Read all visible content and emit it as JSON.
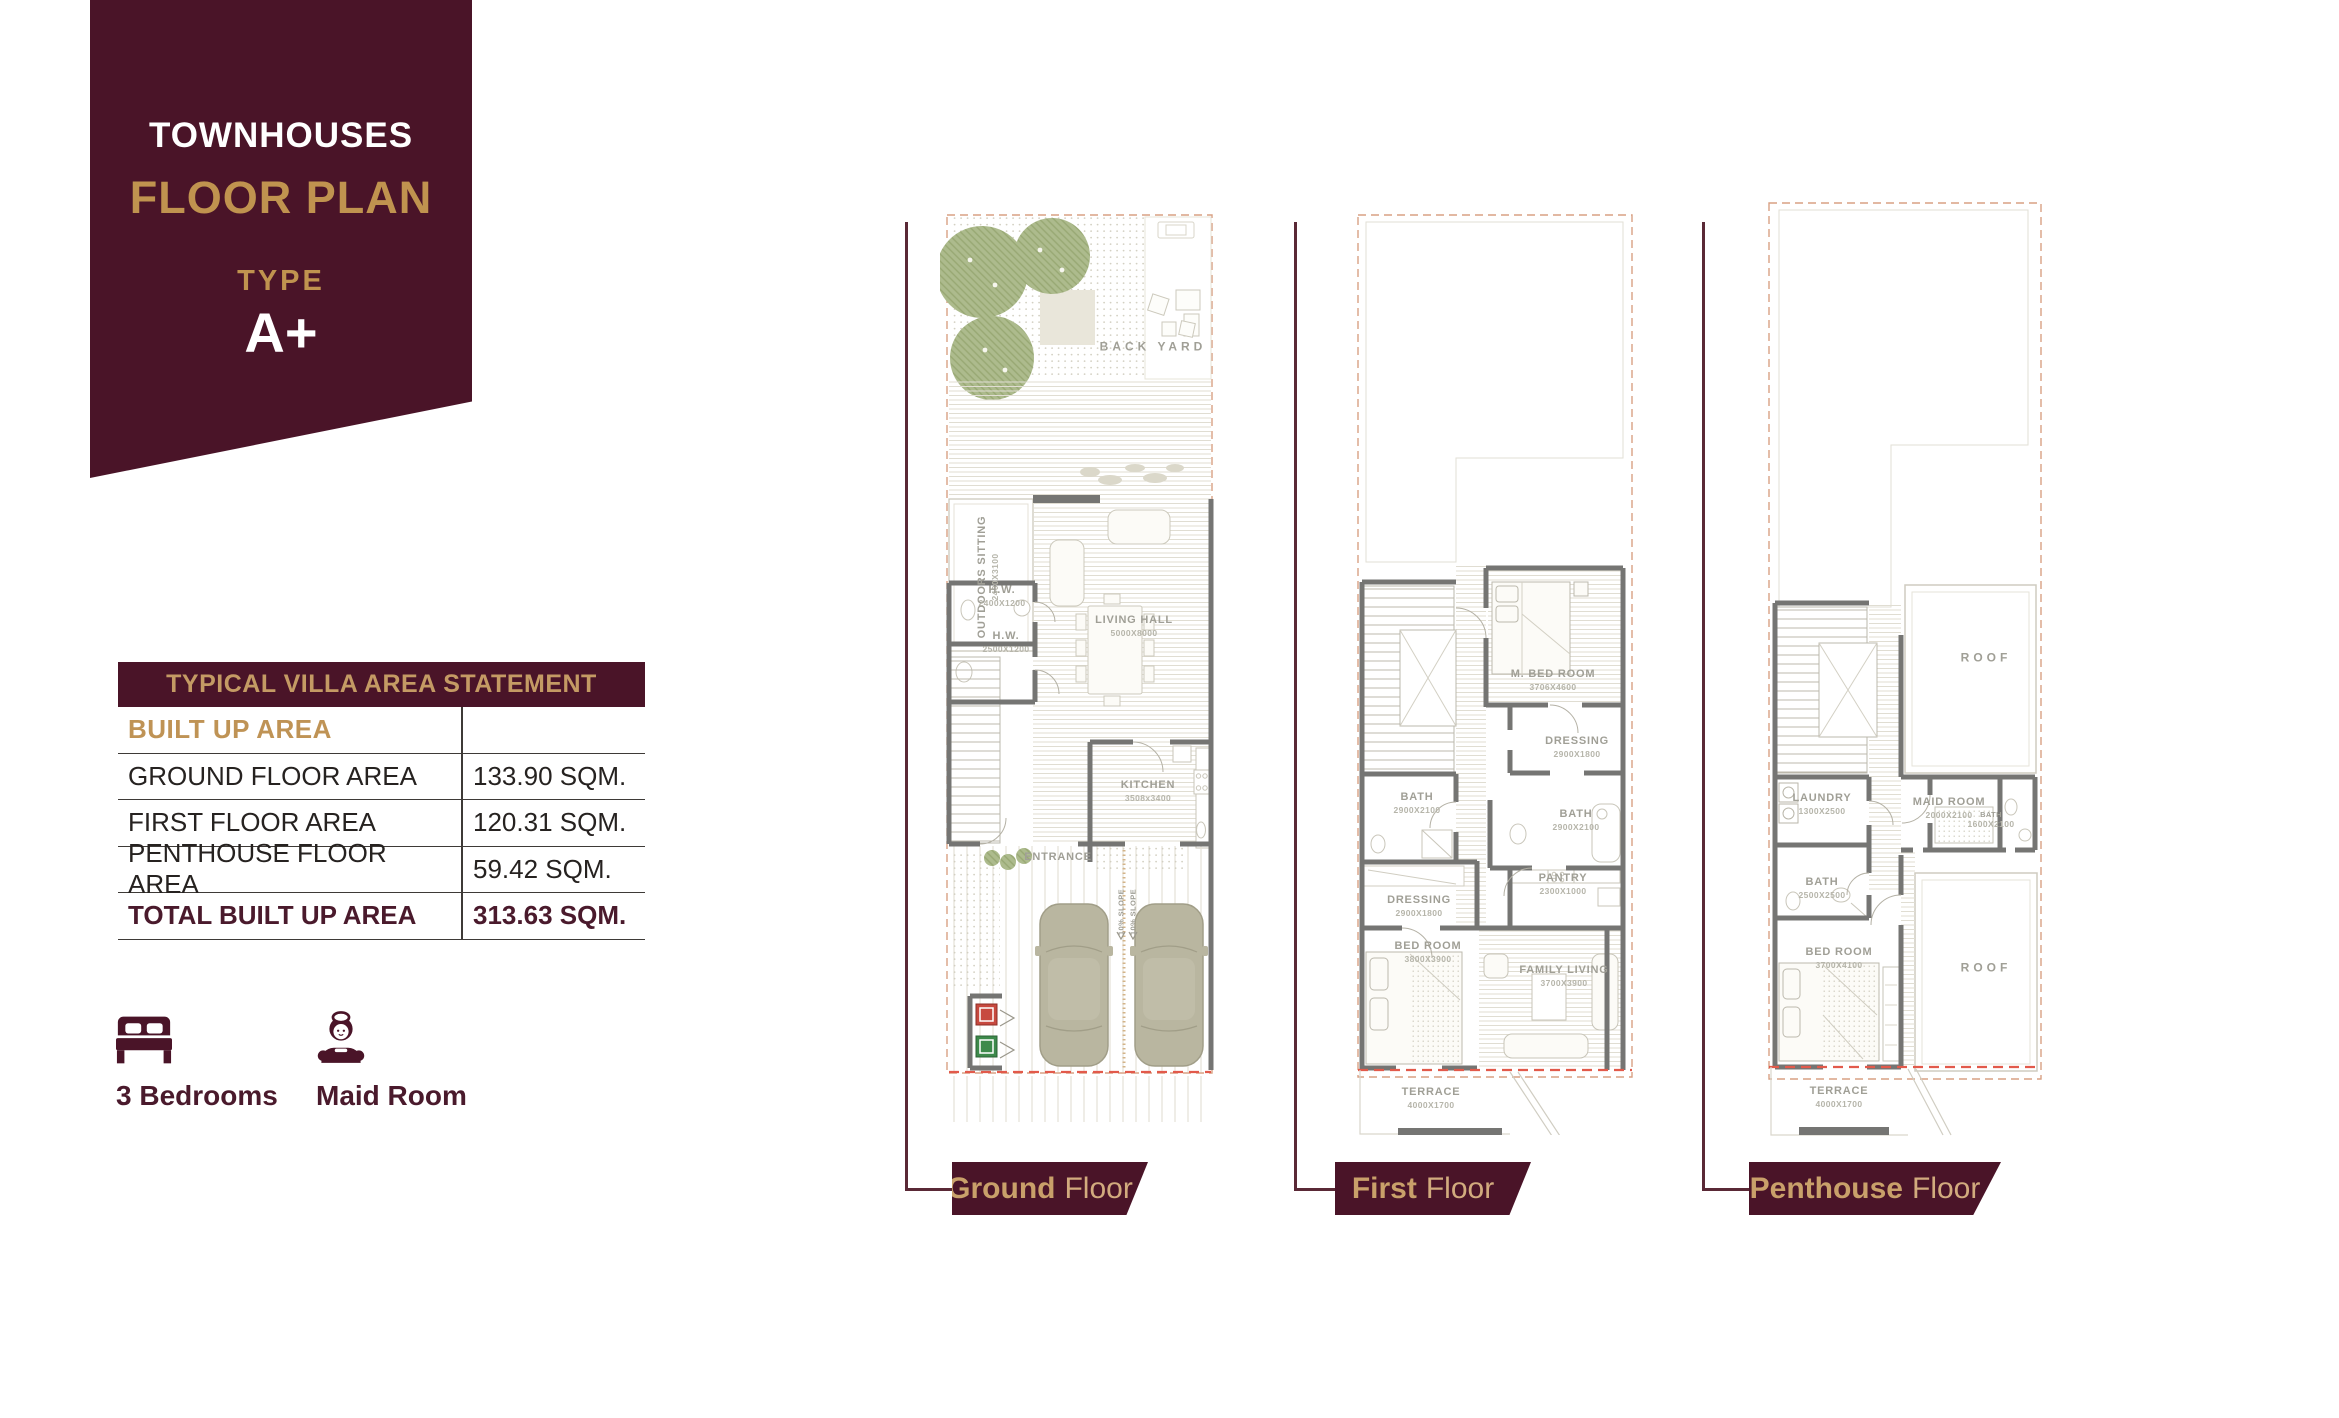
{
  "ribbon": {
    "line1": "TOWNHOUSES",
    "line2": "FLOOR PLAN",
    "type_label": "TYPE",
    "type_value": "A+"
  },
  "area_table": {
    "title": "TYPICAL VILLA AREA STATEMENT",
    "section_header": "BUILT UP AREA",
    "rows": [
      {
        "label": "GROUND FLOOR AREA",
        "value": "133.90 SQM."
      },
      {
        "label": "FIRST FLOOR AREA",
        "value": "120.31 SQM."
      },
      {
        "label": "PENTHOUSE FLOOR AREA",
        "value": "59.42 SQM."
      }
    ],
    "total": {
      "label": "TOTAL BUILT UP AREA",
      "value": "313.63 SQM."
    }
  },
  "features": [
    {
      "icon": "bed-icon",
      "label": "3 Bedrooms"
    },
    {
      "icon": "maid-icon",
      "label": "Maid Room"
    }
  ],
  "colors": {
    "maroon": "#4a1428",
    "gold": "#c0934f",
    "banner_gold": "#c9a06a",
    "wall_gray": "#757573",
    "boundary_dash": "#d9a184",
    "red_dash": "#e25a4b",
    "tree_green": "#adbb8d",
    "car_khaki": "#b9b6a0"
  },
  "plans": [
    {
      "name": "ground",
      "banner": {
        "bold": "Ground",
        "regular": "Floor"
      },
      "labels": [
        {
          "text": "BACK YARD"
        },
        {
          "text": "OUTDOORS SITTING",
          "dims": "2400X3100"
        },
        {
          "text": "H.W.",
          "dims": "2400X1200"
        },
        {
          "text": "H.W.",
          "dims": "2500X1200"
        },
        {
          "text": "LIVING HALL",
          "dims": "5000X8000"
        },
        {
          "text": "KITCHEN",
          "dims": "3508x3400"
        },
        {
          "text": "ENTRANCE"
        },
        {
          "text": "10% SLOPE"
        },
        {
          "text": "10% SLOPE"
        }
      ]
    },
    {
      "name": "first",
      "banner": {
        "bold": "First",
        "regular": "Floor"
      },
      "labels": [
        {
          "text": "M. BED ROOM",
          "dims": "3706X4600"
        },
        {
          "text": "DRESSING",
          "dims": "2900X1800"
        },
        {
          "text": "BATH",
          "dims": "2900X2100"
        },
        {
          "text": "BATH",
          "dims": "2900X2100"
        },
        {
          "text": "PANTRY",
          "dims": "2300X1000"
        },
        {
          "text": "DRESSING",
          "dims": "2900X1800"
        },
        {
          "text": "BED ROOM",
          "dims": "3800X3900"
        },
        {
          "text": "FAMILY LIVING",
          "dims": "3700X3900"
        },
        {
          "text": "TERRACE",
          "dims": "4000X1700"
        }
      ]
    },
    {
      "name": "penthouse",
      "banner": {
        "bold": "Penthouse",
        "regular": "Floor"
      },
      "labels": [
        {
          "text": "ROOF"
        },
        {
          "text": "LAUNDRY",
          "dims": "1300X2500"
        },
        {
          "text": "MAID ROOM",
          "dims": "2000X2100"
        },
        {
          "text": "BATH",
          "dims": "1600X2100"
        },
        {
          "text": "BATH",
          "dims": "2500X2500"
        },
        {
          "text": "BED ROOM",
          "dims": "3700X4100"
        },
        {
          "text": "ROOF"
        },
        {
          "text": "TERRACE",
          "dims": "4000X1700"
        }
      ]
    }
  ]
}
